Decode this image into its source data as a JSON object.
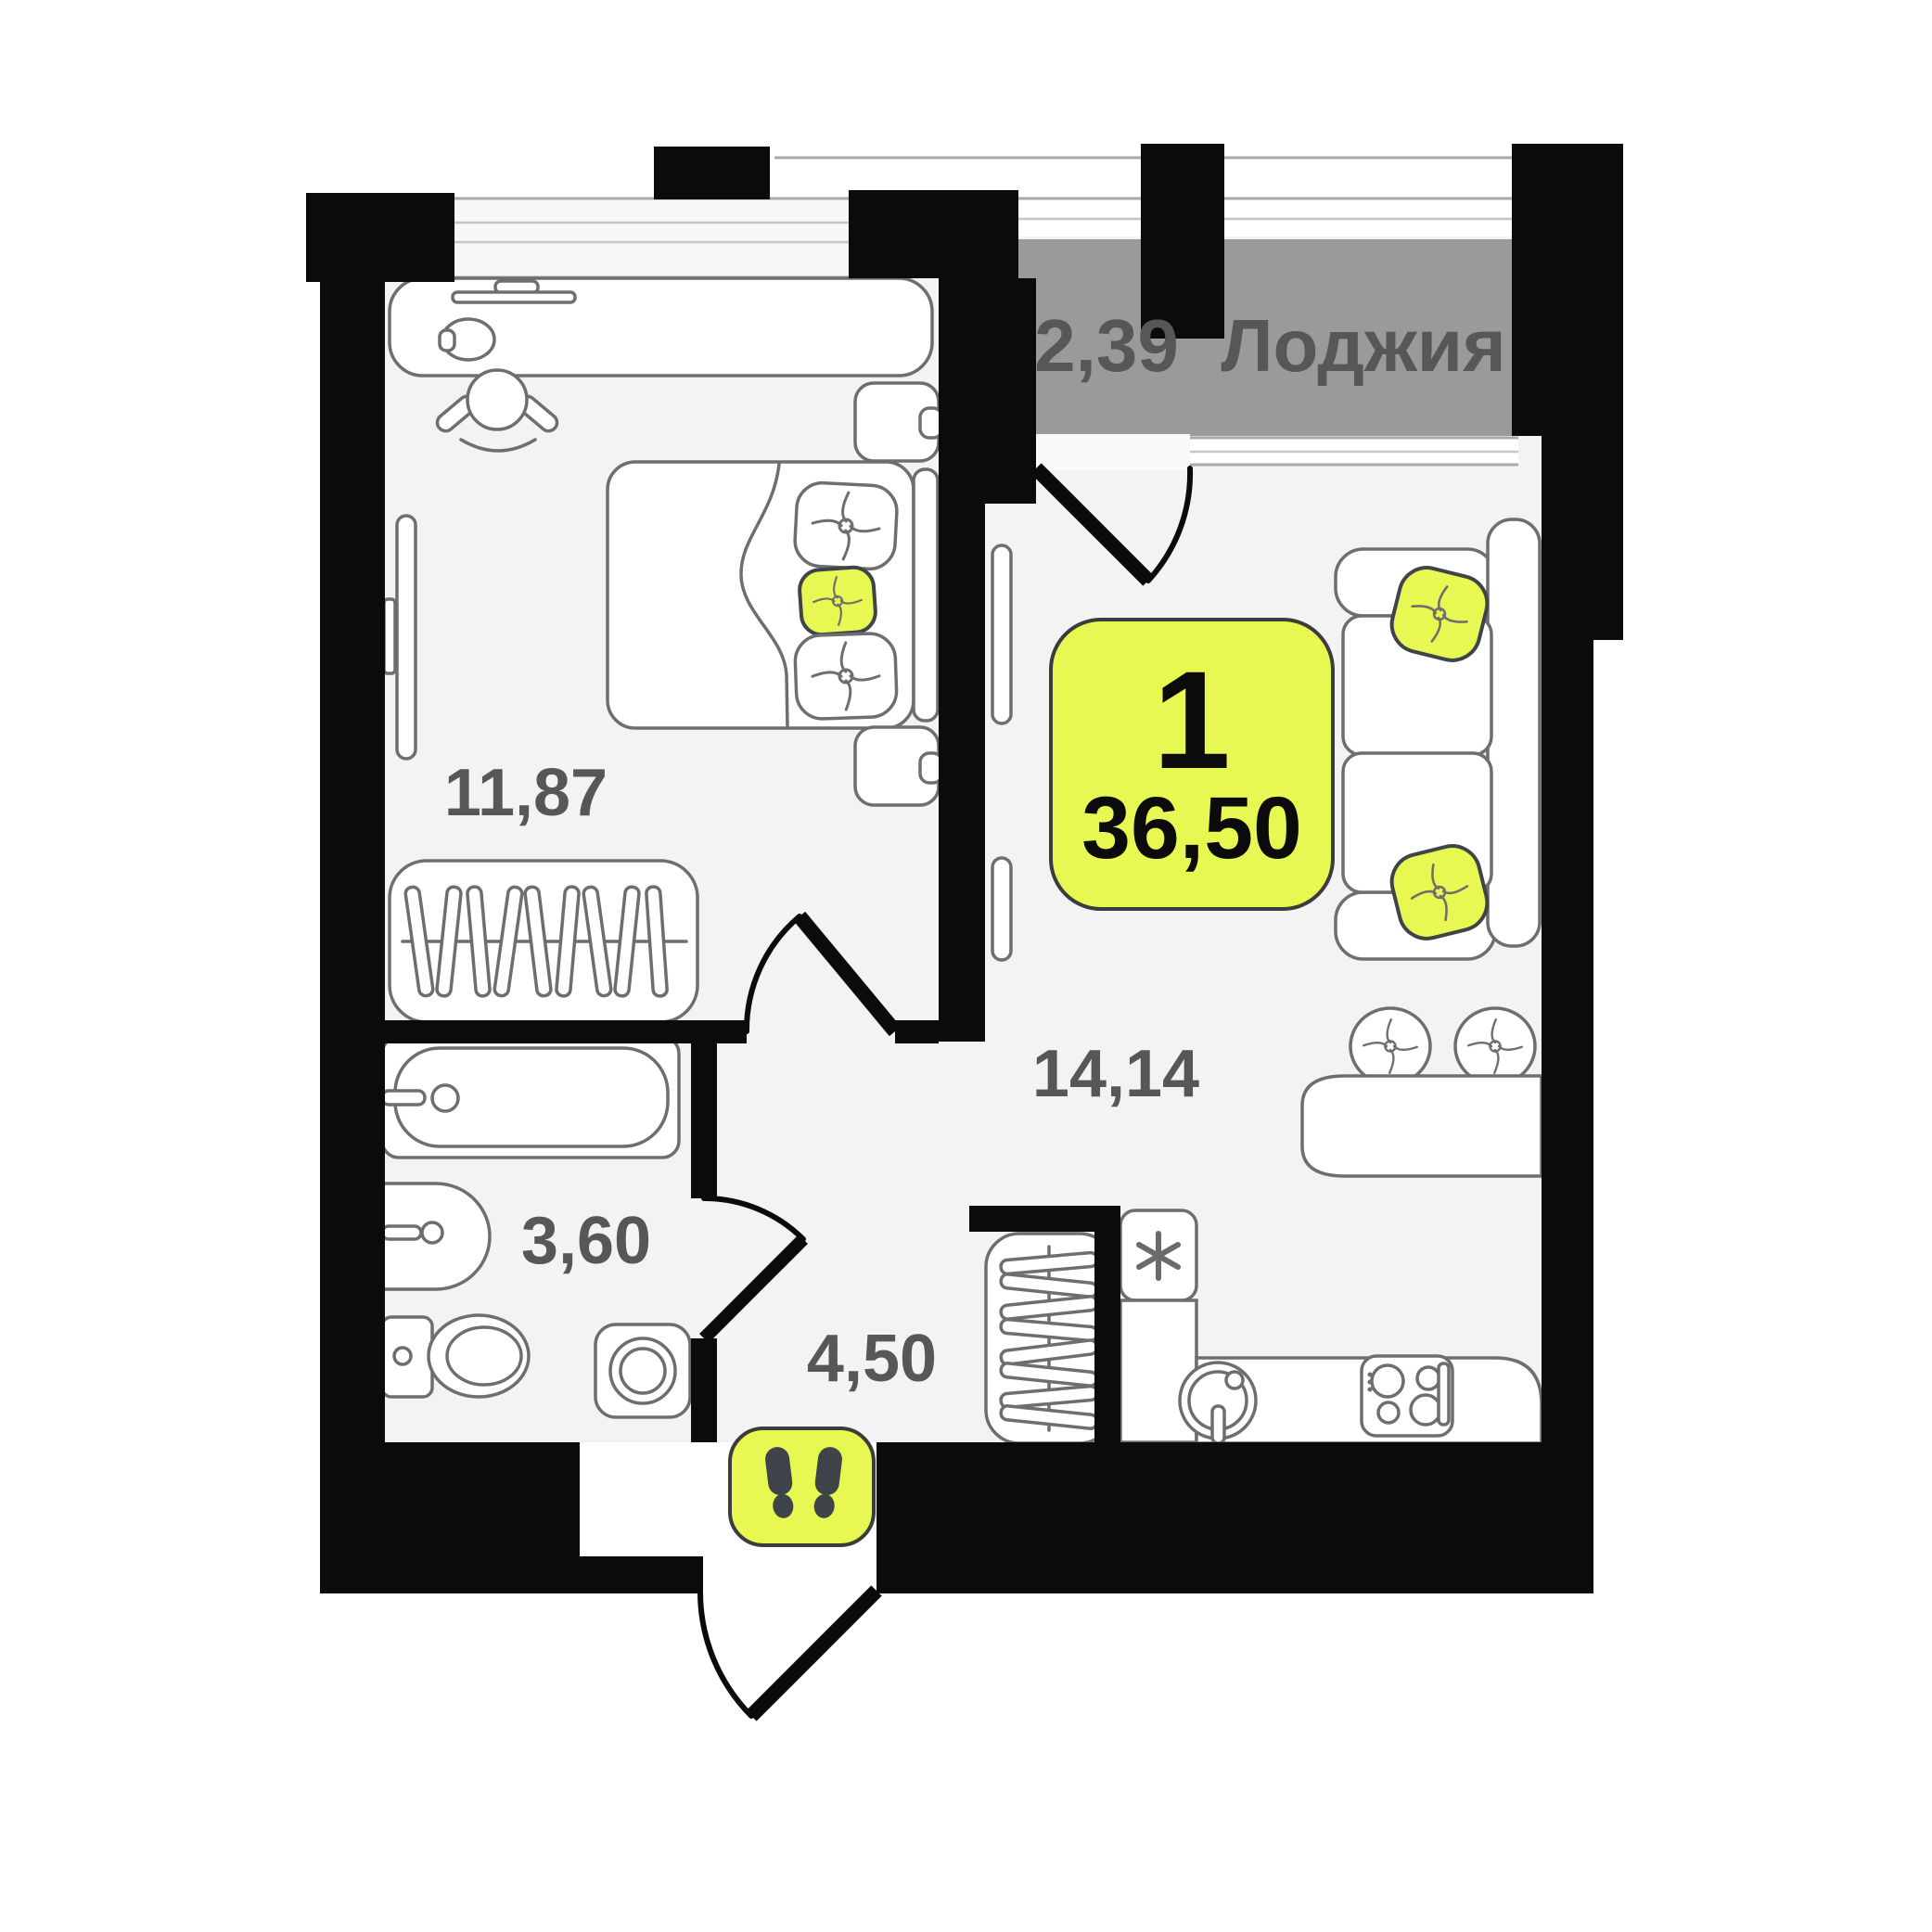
{
  "plan": {
    "badge": {
      "rooms_count": "1",
      "total_area": "36,50"
    },
    "loggia": {
      "area": "2,39",
      "label": "Лоджия"
    },
    "rooms": [
      {
        "name": "bedroom",
        "area": "11,87"
      },
      {
        "name": "living-kitchen",
        "area": "14,14"
      },
      {
        "name": "bathroom",
        "area": "3,60"
      },
      {
        "name": "hallway",
        "area": "4,50"
      }
    ],
    "icons": [
      {
        "name": "footprints-icon"
      },
      {
        "name": "freezer-asterisk-icon"
      }
    ],
    "colors": {
      "accent_yellow": "#e7f852",
      "loggia_gray": "#9a9a9a",
      "wall_black": "#0b0b0b",
      "floor_gray": "#f3f3f3",
      "furniture_stroke": "#6e6e6e",
      "label_gray": "#57575a"
    }
  }
}
